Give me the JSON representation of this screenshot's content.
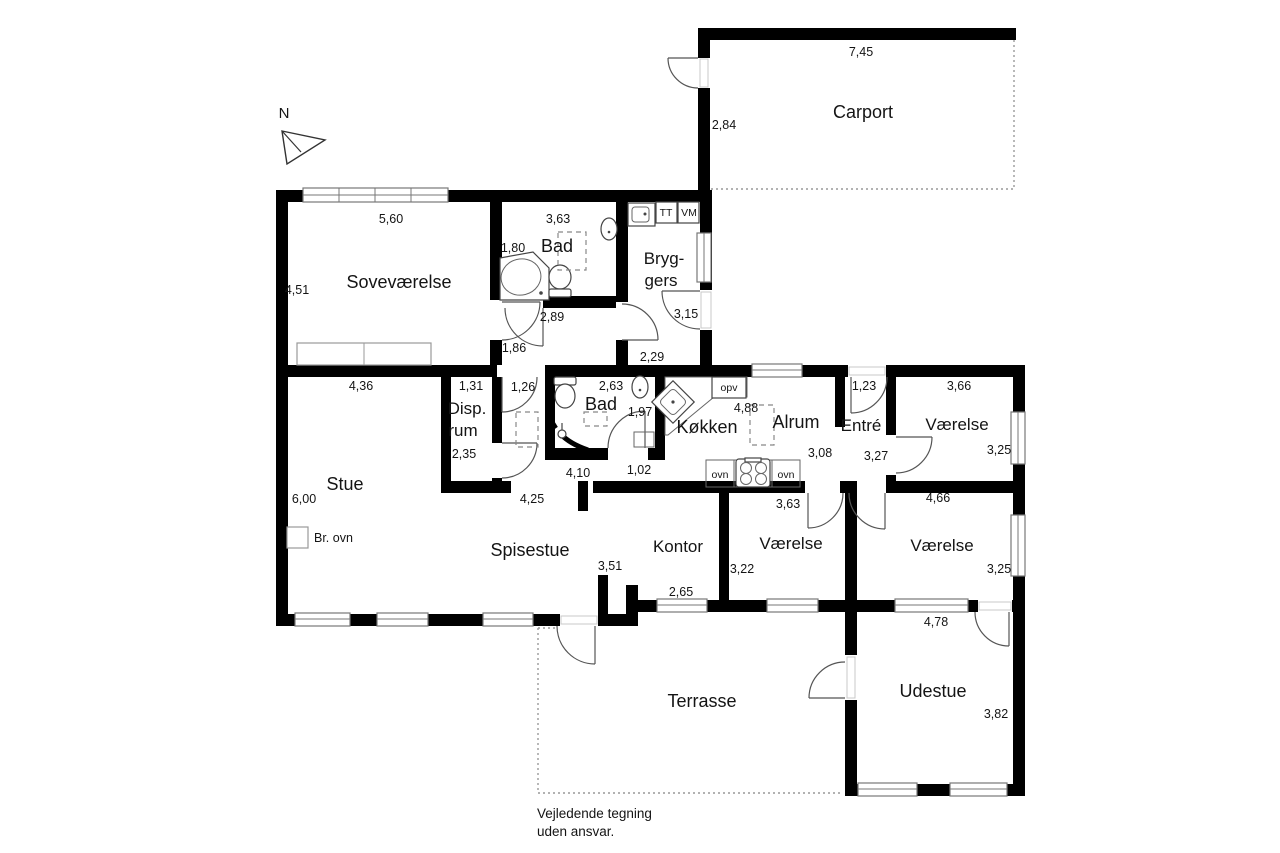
{
  "compass": {
    "label": "N"
  },
  "rooms": {
    "carport": "Carport",
    "sovevaerelse": "Soveværelse",
    "bad1": "Bad",
    "bryggers_line1": "Bryg-",
    "bryggers_line2": "gers",
    "stue": "Stue",
    "disp_line1": "Disp.",
    "disp_line2": "rum",
    "bad2": "Bad",
    "koekken": "Køkken",
    "alrum": "Alrum",
    "entre": "Entré",
    "vaerelse_ne": "Værelse",
    "spisestue": "Spisestue",
    "kontor": "Kontor",
    "vaerelse_mid": "Værelse",
    "vaerelse_se": "Værelse",
    "terrasse": "Terrasse",
    "udestue": "Udestue"
  },
  "dimensions": {
    "carport_width": "7,45",
    "carport_depth": "2,84",
    "sovevaerelse_width": "5,60",
    "sovevaerelse_depth": "4,51",
    "bad1_width": "3,63",
    "bad1_depth": "1,80",
    "bad1_bottom": "2,89",
    "hall1_width": "1,86",
    "bryggers_depth": "3,15",
    "bryggers_width": "2,29",
    "stue_width": "4,36",
    "stue_depth": "6,00",
    "disp_width": "1,31",
    "disp_depth": "2,35",
    "hall2_width": "1,26",
    "bad2_width": "2,63",
    "bad2_depth": "1,97",
    "hall_bottom_width": "4,10",
    "passage_width": "1,02",
    "spisestue_top": "4,25",
    "koekken_width": "4,88",
    "alrum_depth": "3,08",
    "entre_width": "1,23",
    "entre_depth": "3,27",
    "vaerelse_ne_width": "3,66",
    "vaerelse_ne_depth": "3,25",
    "vaerelse_se_top": "4,66",
    "vaerelse_se_depth": "3,25",
    "vaerelse_se_bottom": "4,78",
    "spisestue_right": "3,51",
    "kontor_bottom": "2,65",
    "vaerelse_mid_depth": "3,22",
    "vaerelse_mid_top": "3,63",
    "udestue_depth": "3,82"
  },
  "fixtures": {
    "tumble_dryer": "TT",
    "washing_machine": "VM",
    "dishwasher": "opv",
    "oven_left": "ovn",
    "oven_right": "ovn",
    "wood_stove": "Br. ovn"
  },
  "footer": {
    "line1": "Vejledende tegning",
    "line2": "uden ansvar."
  }
}
